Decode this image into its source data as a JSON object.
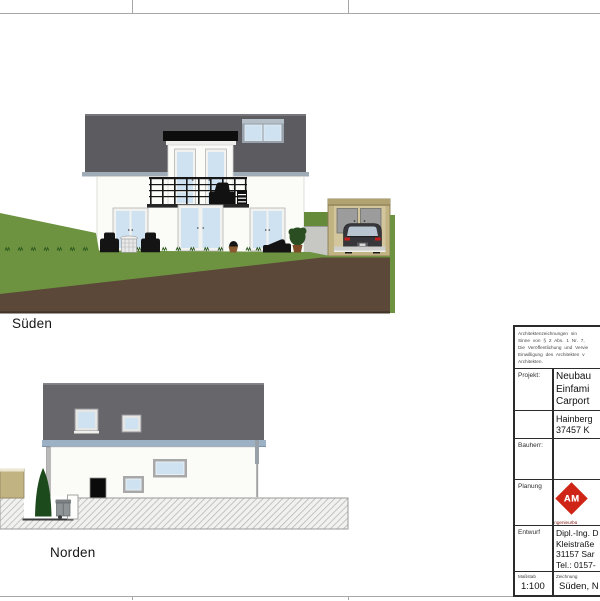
{
  "drawing_labels": {
    "south": "Süden",
    "north": "Norden"
  },
  "title_block": {
    "copyright_lines": [
      "Architektenzeichnungen sin",
      "Sinne von § 2 Abs. 1 Nr. 7,",
      "Die Veröffentlichung und Vervie",
      "Einwilligung des Architekten v",
      "Architekten."
    ],
    "projekt": {
      "label": "Projekt:",
      "lines": [
        "Neubau",
        "Einfami",
        "Carport"
      ]
    },
    "address_lines": [
      "Hainberg",
      "37457 K"
    ],
    "bauherr": {
      "label": "Bauherr:",
      "value": ""
    },
    "planung": {
      "label": "Planung",
      "logo_text": "AM",
      "logo_subtext": "Ingenieurbü"
    },
    "entwurf": {
      "label": "Entwurf",
      "lines": [
        "Dipl.-Ing. D",
        "Kleistraße",
        "31157 Sar",
        "Tel.: 0157-"
      ]
    },
    "massstab": {
      "label": "Maßstab",
      "value": "1:100"
    },
    "zeichnung": {
      "label": "Zeichnung",
      "value": "Süden, N"
    }
  },
  "colors": {
    "roof_gray": "#5c5c60",
    "roof_gray_north": "#67676b",
    "gutter_blue": "#9db1c4",
    "wall_white": "#fbfbf7",
    "window_glass_blue": "#cfe2f2",
    "grass_green": "#6d9340",
    "hedge_green": "#648a3a",
    "earth_brown": "#5b4838",
    "carport_tan": "#c2b383",
    "carport_inner_tan": "#d3c69c",
    "logo_red": "#cf2517",
    "table_line_black": "#2b2b2b",
    "conifer_green": "#1d4a1c"
  }
}
